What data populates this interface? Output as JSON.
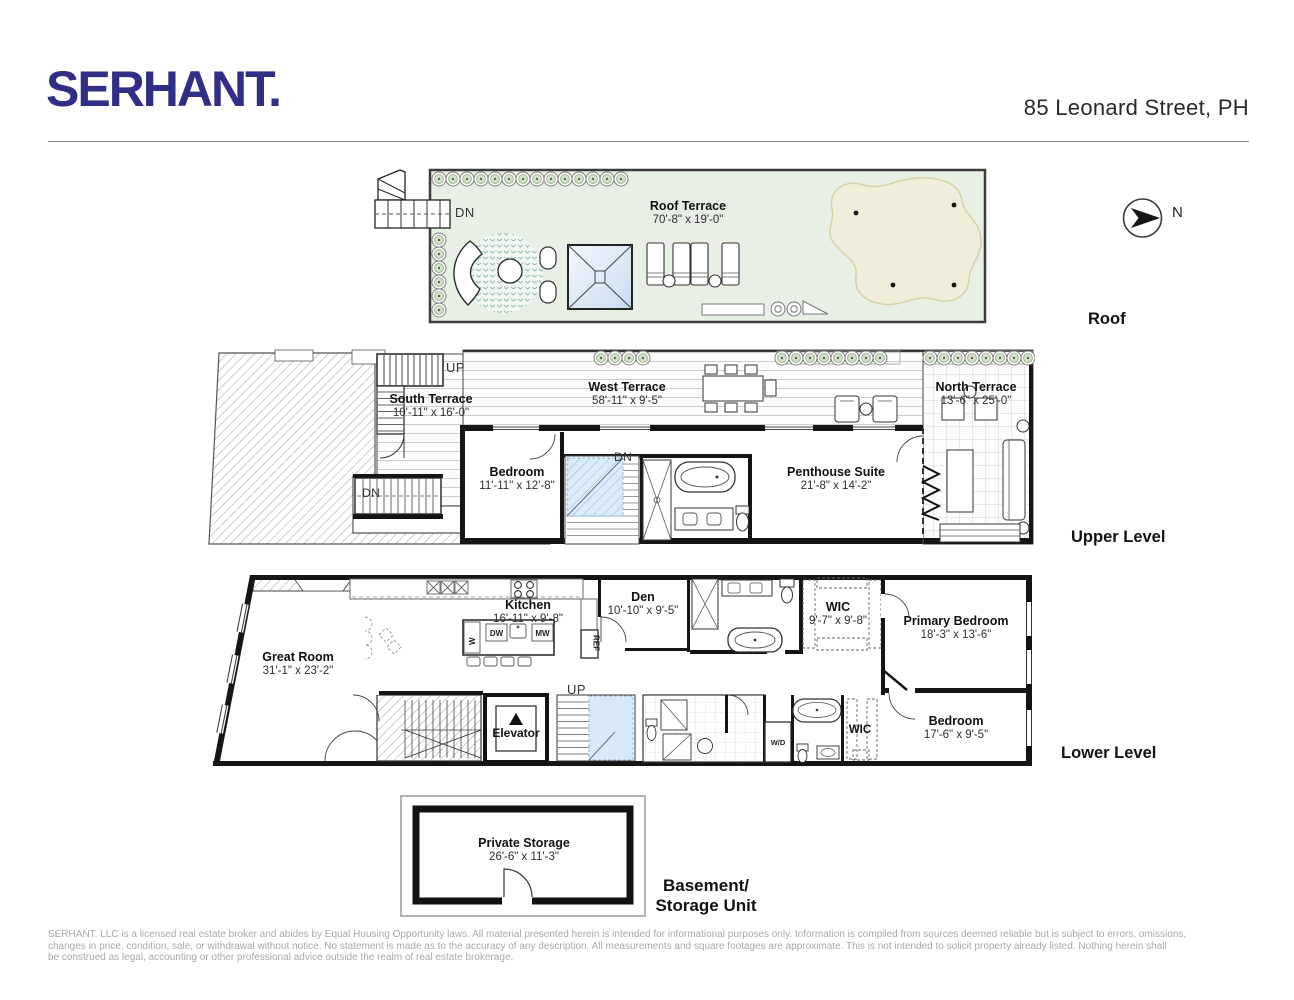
{
  "header": {
    "logo": "SERHANT.",
    "address": "85 Leonard Street, PH"
  },
  "compass_label": "N",
  "levels": {
    "roof": {
      "label": "Roof",
      "dn": "DN",
      "terrace": {
        "name": "Roof Terrace",
        "dims": "70'-8\" x 19'-0\""
      }
    },
    "upper": {
      "label": "Upper Level",
      "up": "UP",
      "dn_stairs": "DN",
      "dn_entry": "DN",
      "south_terrace": {
        "name": "South Terrace",
        "dims": "10'-11\" x 16'-0\""
      },
      "west_terrace": {
        "name": "West Terrace",
        "dims": "58'-11\" x 9'-5\""
      },
      "north_terrace": {
        "name": "North Terrace",
        "dims": "13'-6\" x 25'-0\""
      },
      "bedroom": {
        "name": "Bedroom",
        "dims": "11'-11\" x 12'-8\""
      },
      "penthouse": {
        "name": "Penthouse Suite",
        "dims": "21'-8\" x 14'-2\""
      }
    },
    "lower": {
      "label": "Lower Level",
      "up": "UP",
      "great_room": {
        "name": "Great Room",
        "dims": "31'-1\" x 23'-2\""
      },
      "kitchen": {
        "name": "Kitchen",
        "dims": "16'-11\" x 9'-8\""
      },
      "den": {
        "name": "Den",
        "dims": "10'-10\" x 9'-5\""
      },
      "wic": {
        "name": "WIC",
        "dims": "9'-7\" x 9'-8\""
      },
      "primary_bedroom": {
        "name": "Primary Bedroom",
        "dims": "18'-3\" x 13'-6\""
      },
      "bedroom": {
        "name": "Bedroom",
        "dims": "17'-6\" x 9'-5\""
      },
      "elevator": "Elevator",
      "wic_small": "WIC",
      "appliances": {
        "ref": "REF",
        "w": "W",
        "dw": "DW",
        "mw": "MW",
        "wd": "W/D"
      }
    },
    "basement": {
      "label_line1": "Basement/",
      "label_line2": "Storage Unit",
      "storage": {
        "name": "Private Storage",
        "dims": "26'-6\" x 11'-3\""
      }
    }
  },
  "footer": {
    "line1": "SERHANT. LLC is a licensed real estate broker and abides by Equal Housing Opportunity laws. All material presented herein is intended for informational purposes only. Information is compiled from sources deemed  reliable but is subject to errors, omissions,",
    "line2": "changes in price, condition, sale, or withdrawal without notice. No statement is made as to the accuracy of any description. All measurements and square footages are approximate. This is not intended to solicit property already listed. Nothing herein shall",
    "line3": "be construed as legal, accounting or other professional advice outside the realm of real estate brokerage."
  },
  "colors": {
    "brand_navy": "#312e85",
    "terrace_green": "#e8efe4",
    "lawn_beige": "#f0eedb",
    "skylight_blue": "#c8ddef",
    "stair_blue": "#d8e9f7",
    "footer_gray": "#a9a9a9"
  }
}
